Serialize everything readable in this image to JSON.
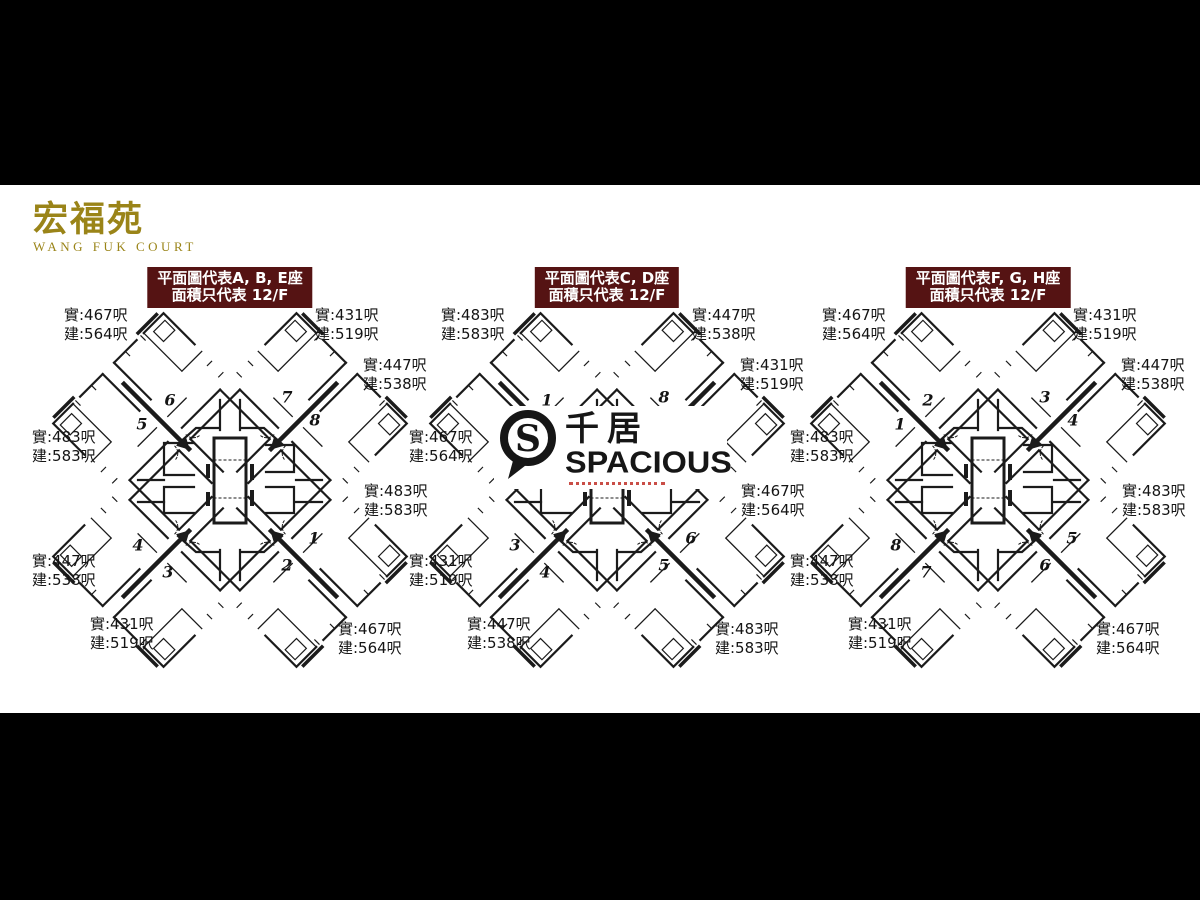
{
  "brand": {
    "name_zh": "宏福苑",
    "name_en": "WANG FUK COURT",
    "color": "#9a8418"
  },
  "watermark": {
    "badge_letter": "S",
    "logo_zh": "千居",
    "logo_en": "SPACIOUS"
  },
  "colors": {
    "letterbox": "#000000",
    "sheet_background": "#ffffff",
    "plan_header_bg": "#551313",
    "plan_header_text": "#ffffff",
    "plan_lines": "#1b1b1b",
    "watermark_accent": "#c03028"
  },
  "plans": [
    {
      "header": {
        "line1": "平面圖代表A, B, E座",
        "line2": "面積只代表 12/F"
      },
      "unit_numbers": {
        "nw_inner": "6",
        "nw_outer": "5",
        "ne_inner": "7",
        "ne_outer": "8",
        "sw_outer": "4",
        "sw_inner": "3",
        "se_inner": "2",
        "se_outer": "1"
      },
      "area_labels": {
        "tl": {
          "saleable": "實:467呎",
          "gross": "建:564呎"
        },
        "tr": {
          "saleable": "實:431呎",
          "gross": "建:519呎"
        },
        "ru": {
          "saleable": "實:447呎",
          "gross": "建:538呎"
        },
        "rl": {
          "saleable": "實:483呎",
          "gross": "建:583呎"
        },
        "br": {
          "saleable": "實:467呎",
          "gross": "建:564呎"
        },
        "bl": {
          "saleable": "實:431呎",
          "gross": "建:519呎"
        },
        "ll": {
          "saleable": "實:447呎",
          "gross": "建:538呎"
        },
        "lu": {
          "saleable": "實:483呎",
          "gross": "建:583呎"
        }
      }
    },
    {
      "header": {
        "line1": "平面圖代表C, D座",
        "line2": "面積只代表 12/F"
      },
      "unit_numbers": {
        "nw_inner": "1",
        "nw_outer": "",
        "ne_inner": "8",
        "ne_outer": "7",
        "sw_outer": "3",
        "sw_inner": "4",
        "se_inner": "5",
        "se_outer": "6"
      },
      "area_labels": {
        "tl": {
          "saleable": "實:483呎",
          "gross": "建:583呎"
        },
        "tr": {
          "saleable": "實:447呎",
          "gross": "建:538呎"
        },
        "ru": {
          "saleable": "實:431呎",
          "gross": "建:519呎"
        },
        "rl": {
          "saleable": "實:467呎",
          "gross": "建:564呎"
        },
        "br": {
          "saleable": "實:483呎",
          "gross": "建:583呎"
        },
        "bl": {
          "saleable": "實:447呎",
          "gross": "建:538呎"
        },
        "ll": {
          "saleable": "實:431呎",
          "gross": "建:519呎"
        },
        "lu": {
          "saleable": "實:467呎",
          "gross": "建:564呎"
        }
      }
    },
    {
      "header": {
        "line1": "平面圖代表F, G, H座",
        "line2": "面積只代表 12/F"
      },
      "unit_numbers": {
        "nw_inner": "2",
        "nw_outer": "1",
        "ne_inner": "3",
        "ne_outer": "4",
        "sw_outer": "8",
        "sw_inner": "7",
        "se_inner": "6",
        "se_outer": "5"
      },
      "area_labels": {
        "tl": {
          "saleable": "實:467呎",
          "gross": "建:564呎"
        },
        "tr": {
          "saleable": "實:431呎",
          "gross": "建:519呎"
        },
        "ru": {
          "saleable": "實:447呎",
          "gross": "建:538呎"
        },
        "rl": {
          "saleable": "實:483呎",
          "gross": "建:583呎"
        },
        "br": {
          "saleable": "實:467呎",
          "gross": "建:564呎"
        },
        "bl": {
          "saleable": "實:431呎",
          "gross": "建:519呎"
        },
        "ll": {
          "saleable": "實:447呎",
          "gross": "建:538呎"
        },
        "lu": {
          "saleable": "實:483呎",
          "gross": "建:583呎"
        }
      }
    }
  ]
}
